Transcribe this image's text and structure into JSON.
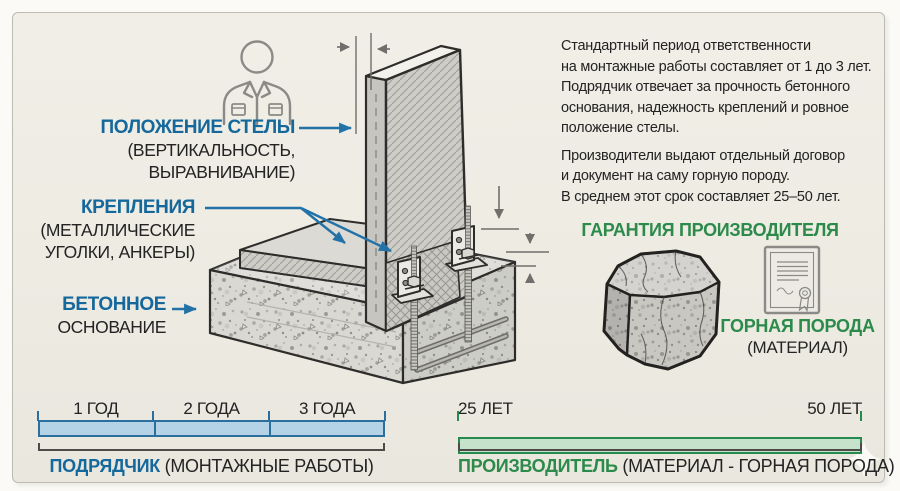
{
  "colors": {
    "blue": "#15689c",
    "green": "#2c8a4b",
    "dark": "#232323",
    "bar_blue_fill": "#b5d3e7",
    "bar_blue_border": "#2a6f9e",
    "bar_green_fill": "#c6e2cb",
    "bar_green_border": "#278a4e",
    "card_bg": "#edebe2"
  },
  "callouts": {
    "stele_position": {
      "title": "ПОЛОЖЕНИЕ СТЕЛЫ",
      "line2": "(ВЕРТИКАЛЬНОСТЬ,",
      "line3": "ВЫРАВНИВАНИЕ)"
    },
    "fasteners": {
      "title": "КРЕПЛЕНИЯ",
      "line2": "(МЕТАЛЛИЧЕСКИЕ",
      "line3": "УГОЛКИ, АНКЕРЫ)"
    },
    "foundation": {
      "title": "БЕТОННОЕ",
      "line2": "ОСНОВАНИЕ"
    }
  },
  "info": {
    "p1": [
      "Стандартный период ответственности",
      "на монтажные работы составляет от 1 до 3 лет.",
      "Подрядчик отвечает за прочность бетонного",
      "основания, надежность креплений и ровное",
      "положение стелы."
    ],
    "p2": [
      "Производители выдают отдельный договор",
      "и документ на саму горную породу.",
      "В среднем этот срок составляет 25–50 лет."
    ]
  },
  "warranty": {
    "heading": "ГАРАНТИЯ ПРОИЗВОДИТЕЛЯ",
    "material_title": "ГОРНАЯ ПОРОДА",
    "material_sub": "(МАТЕРИАЛ)"
  },
  "timelines": {
    "contractor": {
      "ticks": [
        "1 ГОД",
        "2 ГОДА",
        "3 ГОДА"
      ],
      "label": "ПОДРЯДЧИК",
      "label_note": "(МОНТАЖНЫЕ РАБОТЫ)"
    },
    "manufacturer": {
      "start": "25 ЛЕТ",
      "end": "50 ЛЕТ",
      "label": "ПРОИЗВОДИТЕЛЬ",
      "label_note": "(МАТЕРИАЛ - ГОРНАЯ ПОРОДА)"
    }
  },
  "icons": {
    "worker": "worker-icon",
    "certificate": "certificate-icon",
    "rock": "rock-stone",
    "sparkle": "sparkle-decoration"
  }
}
